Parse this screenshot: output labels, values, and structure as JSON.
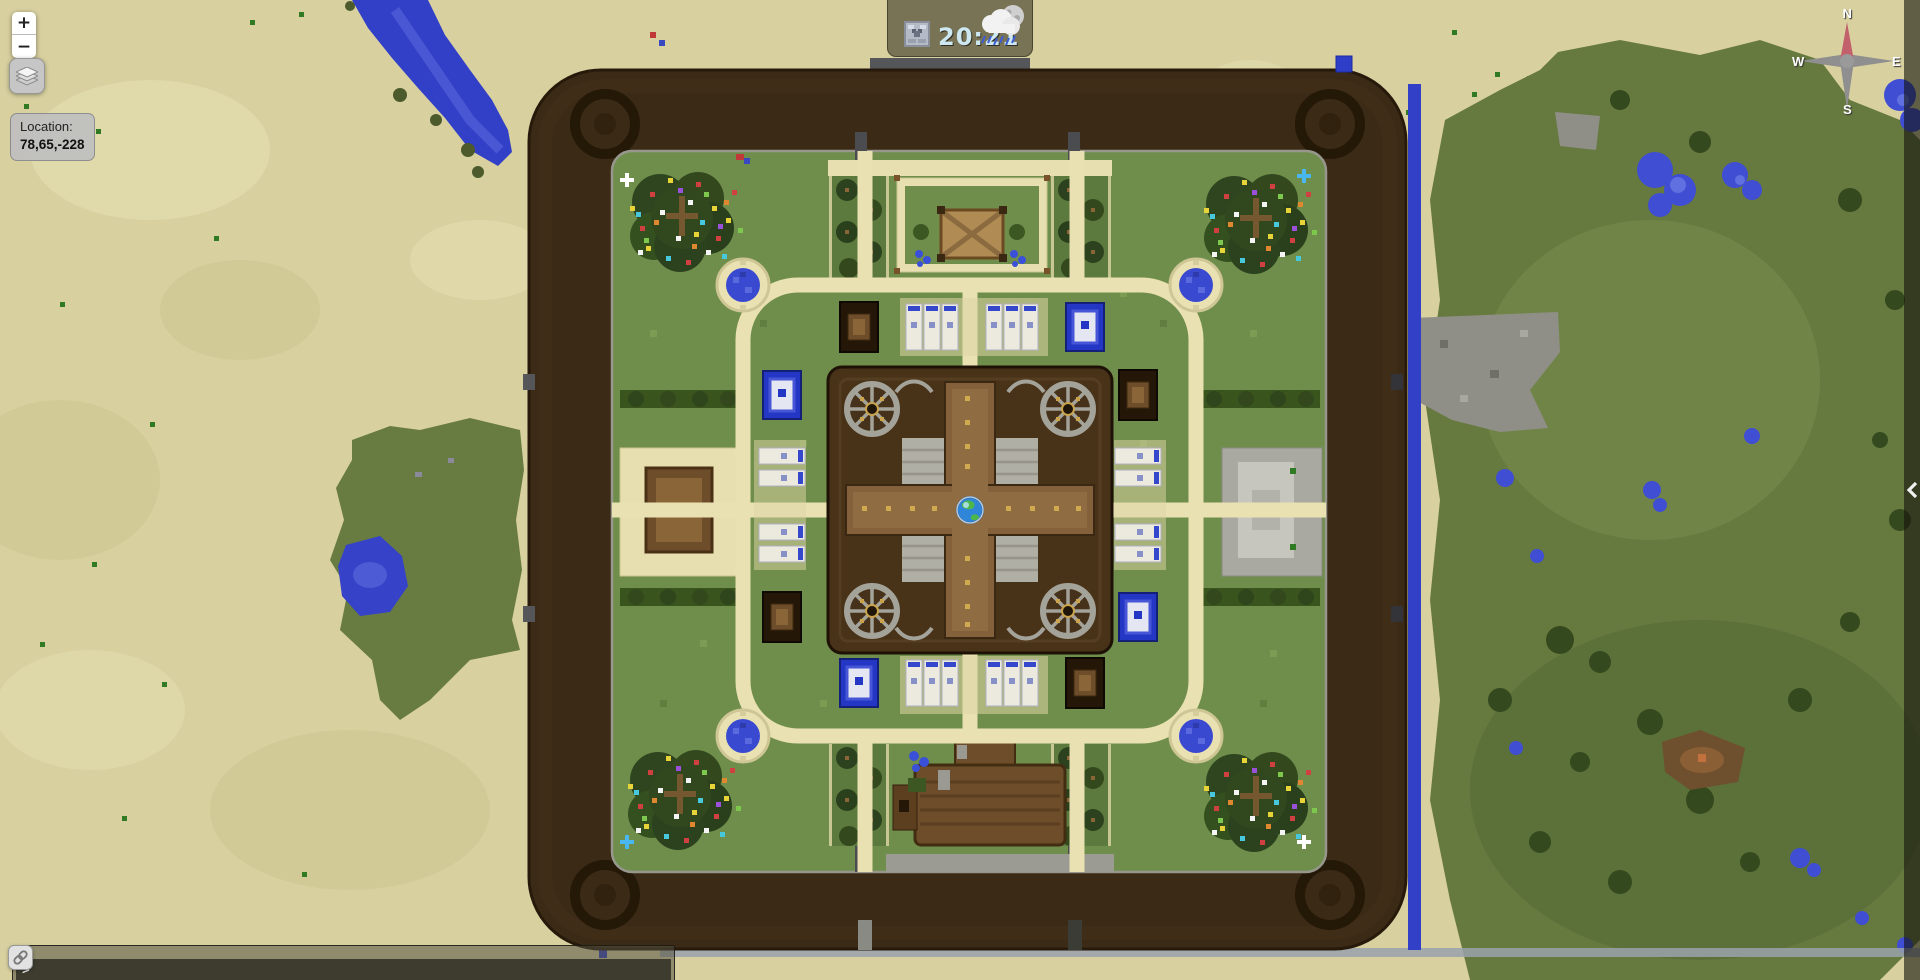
{
  "ui": {
    "zoom_control": {
      "zoom_in": "+",
      "zoom_out": "−"
    },
    "layers_button": {
      "icon": "layers-icon"
    },
    "location_panel": {
      "label": "Location:",
      "coordinates": "78,65,-228"
    },
    "clock_panel": {
      "time": "20:21",
      "clock_icon": "clock-icon",
      "weather_icon": "weather-rain-moon-icon"
    },
    "compass": {
      "north": "N",
      "east": "E",
      "south": "S",
      "west": "W"
    },
    "chat_bar": {
      "prompt": ">"
    },
    "link_button": {
      "icon": "link-icon"
    },
    "sidebar_toggle": {
      "icon": "chevron-left-icon"
    }
  },
  "map": {
    "spawn_marker": {
      "icon": "globe-marker"
    },
    "palette": {
      "desert_sand": "#d8d09f",
      "forest_green": "#66793f",
      "courtyard_grass": "#6f8e4b",
      "castle_wall_brown": "#3b2a15",
      "path_sandstone": "#e9e1b2",
      "water_blue": "#3a46c9",
      "stone_grey": "#9b9b93",
      "wood_brown": "#6e4d2a",
      "clock_text": "#cde8f0"
    }
  }
}
